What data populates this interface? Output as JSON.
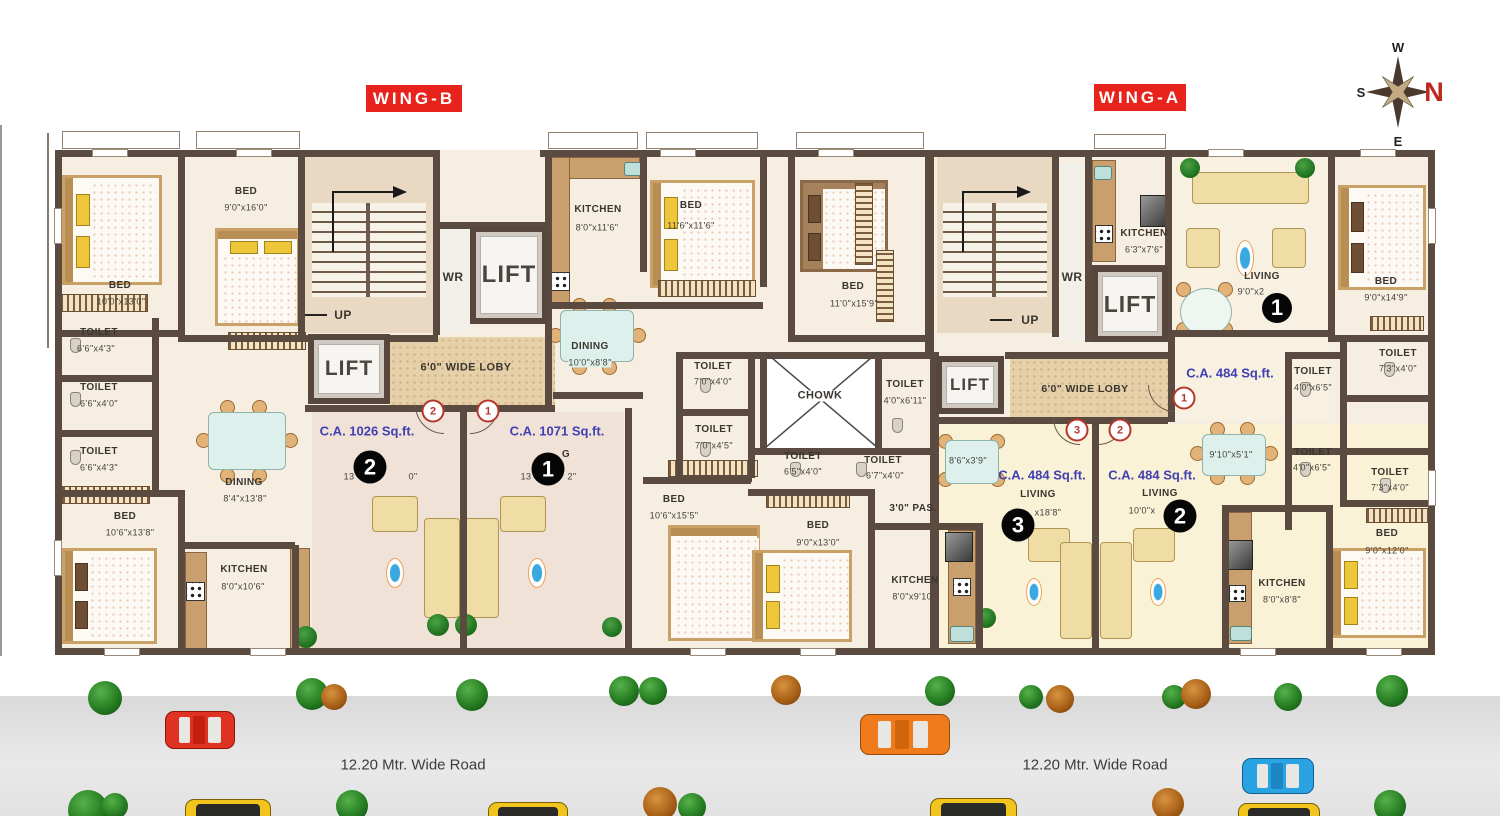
{
  "wings": {
    "b": "WING-B",
    "a": "WING-A"
  },
  "compass": {
    "n": "N",
    "s": "S",
    "e": "E",
    "w": "W"
  },
  "road": {
    "left": "12.20 Mtr. Wide Road",
    "right": "12.20 Mtr. Wide Road"
  },
  "core": {
    "lift": "LIFT",
    "wr": "WR",
    "up": "UP",
    "lobby": "6'0\" WIDE LOBY",
    "chowk": "CHOWK",
    "passage": "3'0\" PAS."
  },
  "units": {
    "b2": {
      "ca": "C.A. 1026 Sq.ft.",
      "num": "2",
      "tag": "2",
      "dimL": "13",
      "dimR": "0\""
    },
    "b1": {
      "ca": "C.A. 1071 Sq.ft.",
      "num": "1",
      "tag": "1",
      "nameFrag": "G",
      "dimL": "13",
      "dimR": "2\""
    },
    "a1": {
      "ca": "C.A. 484 Sq.ft.",
      "num": "1",
      "tag": "1",
      "living": "LIVING",
      "dims": "9'0\"x2"
    },
    "a3": {
      "ca": "C.A. 484 Sq.ft.",
      "num": "3",
      "tag": "3",
      "living": "LIVING",
      "dims": "x18'8\""
    },
    "a2": {
      "ca": "C.A. 484 Sq.ft.",
      "num": "2",
      "tag": "2",
      "living": "LIVING",
      "dims": "10'0\"x"
    }
  },
  "rooms": {
    "bedBtl": {
      "n": "BED",
      "d": "10'0\"x13'0\""
    },
    "bedBt2": {
      "n": "BED",
      "d": "9'0\"x16'0\""
    },
    "toiB1": {
      "n": "TOILET",
      "d": "6'6\"x4'3\""
    },
    "toiB2": {
      "n": "TOILET",
      "d": "6'6\"x4'0\""
    },
    "toiB3": {
      "n": "TOILET",
      "d": "6'6\"x4'3\""
    },
    "dinB": {
      "n": "DINING",
      "d": "8'4\"x13'8\""
    },
    "bedBbl": {
      "n": "BED",
      "d": "10'6\"x13'8\""
    },
    "kitB": {
      "n": "KITCHEN",
      "d": "8'0\"x10'6\""
    },
    "kitB1": {
      "n": "KITCHEN",
      "d": "8'0\"x11'6\""
    },
    "bedB1a": {
      "n": "BED",
      "d": "11'6\"x11'6\""
    },
    "dinB1": {
      "n": "DINING",
      "d": "10'0\"x8'8\""
    },
    "bedB1b": {
      "n": "BED",
      "d": "11'0\"x15'9\""
    },
    "toiB4": {
      "n": "TOILET",
      "d": "7'0\"x4'0\""
    },
    "toiB5": {
      "n": "TOILET",
      "d": "7'0\"x4'5\""
    },
    "toiM": {
      "n": "TOILET",
      "d": "4'0\"x6'11\""
    },
    "bedB1c": {
      "n": "BED",
      "d": "10'6\"x15'5\""
    },
    "toiA3a": {
      "n": "TOILET",
      "d": "6'5\"x4'0\""
    },
    "toiA3b": {
      "n": "TOILET",
      "d": "6'7\"x4'0\""
    },
    "bedA3": {
      "n": "BED",
      "d": "9'0\"x13'0\""
    },
    "kitA3": {
      "n": "KITCHEN",
      "d": "8'0\"x9'10\""
    },
    "kitA1": {
      "n": "KITCHEN",
      "d": "6'3\"x7'6\""
    },
    "bedA1": {
      "n": "BED",
      "d": "9'0\"x14'9\""
    },
    "toiA1a": {
      "n": "TOILET",
      "d": "4'0\"x6'5\""
    },
    "toiA1b": {
      "n": "TOILET",
      "d": "7'3\"x4'0\""
    },
    "toiA2a": {
      "n": "TOILET",
      "d": "4'0\"x6'5\""
    },
    "toiA2b": {
      "n": "TOILET",
      "d": "7'3\"x4'0\""
    },
    "kitA2": {
      "n": "KITCHEN",
      "d": "8'0\"x8'8\""
    },
    "bedA2": {
      "n": "BED",
      "d": "9'0\"x12'0\""
    }
  },
  "furniture": {
    "tableA3": "8'6\"x3'9\"",
    "tableA2": "9'10\"x5'1\""
  }
}
